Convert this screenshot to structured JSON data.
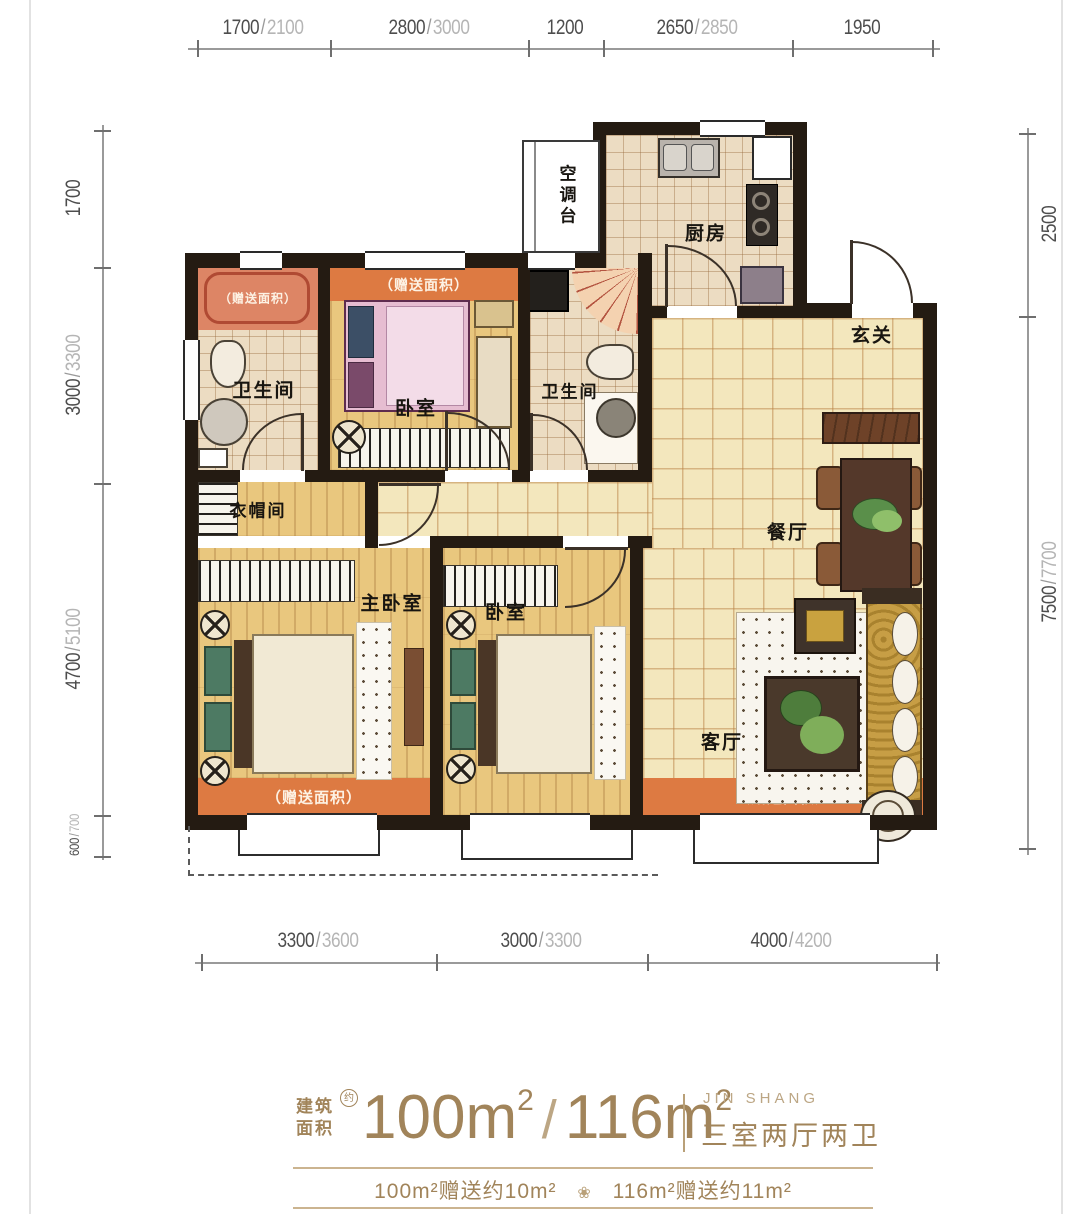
{
  "colors": {
    "wall": "#241b12",
    "accent_orange": "#dd7a42",
    "salmon": "#dd8565",
    "bronze": "#a1845a",
    "wood": "#e9c77e",
    "tile": "#f3e7bd"
  },
  "dimensions": {
    "separator": "/",
    "top": [
      {
        "main": "1700",
        "alt": "2100"
      },
      {
        "main": "2800",
        "alt": "3000"
      },
      {
        "main": "1200",
        "alt": ""
      },
      {
        "main": "2650",
        "alt": "2850"
      },
      {
        "main": "1950",
        "alt": ""
      }
    ],
    "left": [
      {
        "main": "1700",
        "alt": ""
      },
      {
        "main": "3000",
        "alt": "3300"
      },
      {
        "main": "4700",
        "alt": "5100"
      },
      {
        "main": "600",
        "alt": "700"
      }
    ],
    "right": [
      {
        "main": "2500",
        "alt": ""
      },
      {
        "main": "7500",
        "alt": "7700"
      }
    ],
    "bottom": [
      {
        "main": "3300",
        "alt": "3600"
      },
      {
        "main": "3000",
        "alt": "3300"
      },
      {
        "main": "4000",
        "alt": "4200"
      }
    ]
  },
  "rooms": {
    "ac_platform": "空调台",
    "kitchen": "厨房",
    "entry": "玄关",
    "bath1": "卫生间",
    "bath2": "卫生间",
    "bedroom_top": "卧室",
    "cloakroom": "衣帽间",
    "master_bedroom": "主卧室",
    "bedroom2": "卧室",
    "dining": "餐厅",
    "living": "客厅"
  },
  "gift_area_label": "（赠送面积）",
  "footer": {
    "area_prefix_line1": "建筑",
    "area_prefix_line2": "面积",
    "approx_badge": "约",
    "area_value_1": "100",
    "area_value_2": "116",
    "area_unit": "m",
    "area_sup": "2",
    "slash": "/",
    "brand_en": "JIN SHANG",
    "layout_type": "三室两厅两卫",
    "gift_note_1": "100m²赠送约10m²",
    "gift_note_2": "116m²赠送约11m²",
    "divider_glyph": "❀"
  }
}
